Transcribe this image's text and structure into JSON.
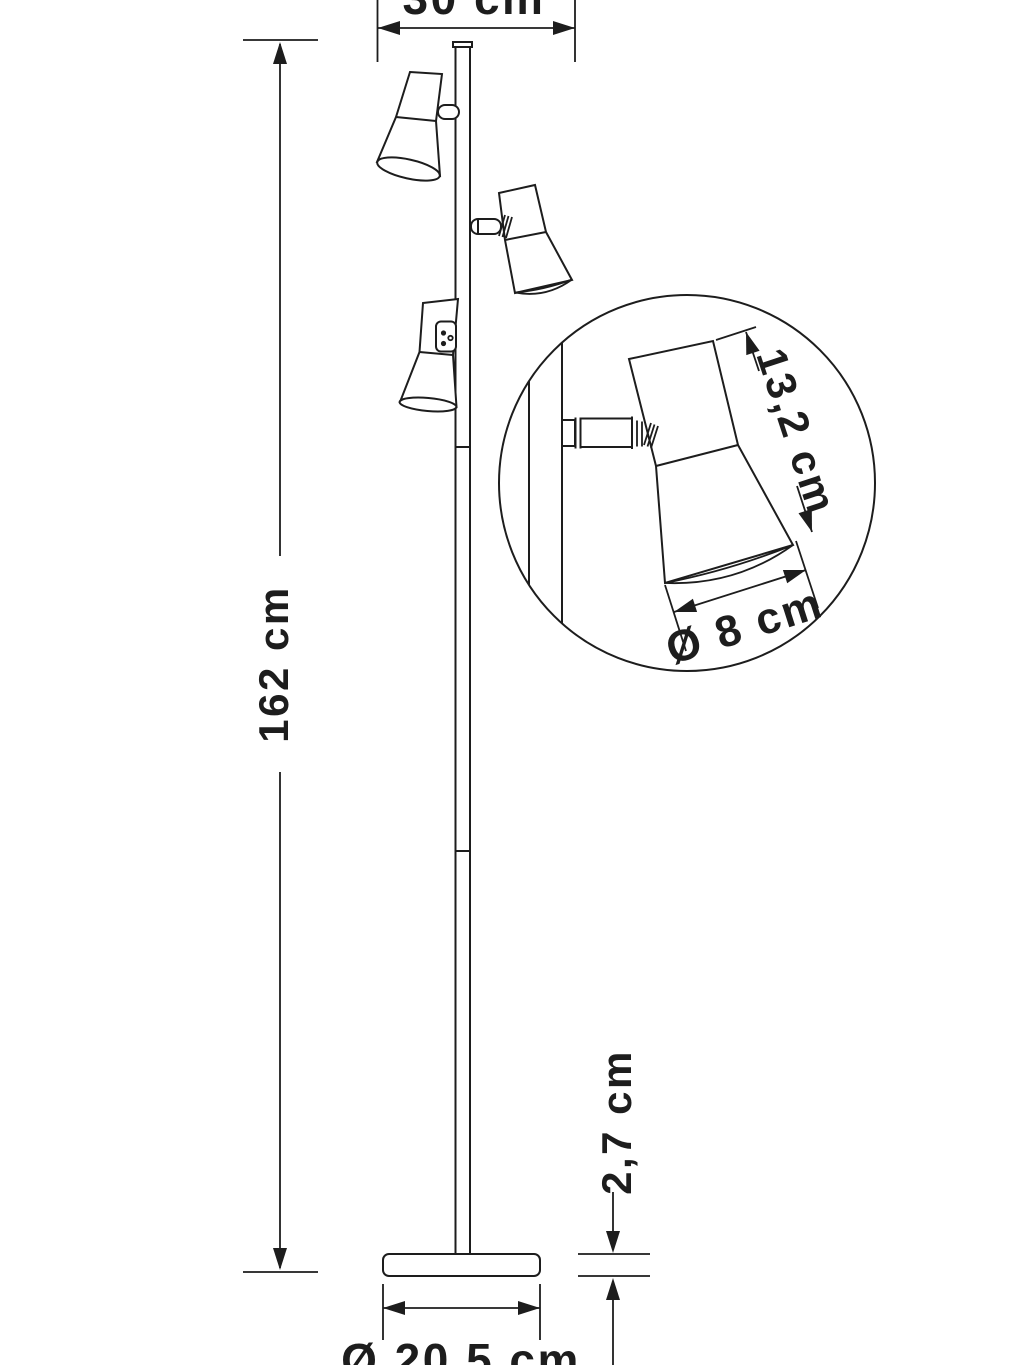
{
  "diagram": {
    "title": "floor-lamp-dimension-drawing",
    "subject": "three-head floor lamp line drawing with dimension annotations and magnified shade detail circle",
    "labels": {
      "top_width": "30 cm",
      "total_height": "162 cm",
      "shade_height": "13,2 cm",
      "shade_diameter": "Ø 8 cm",
      "base_height": "2,7 cm",
      "base_diameter": "Ø 20,5 cm"
    },
    "colors": {
      "line": "#1d1d1d",
      "background": "#ffffff"
    }
  }
}
